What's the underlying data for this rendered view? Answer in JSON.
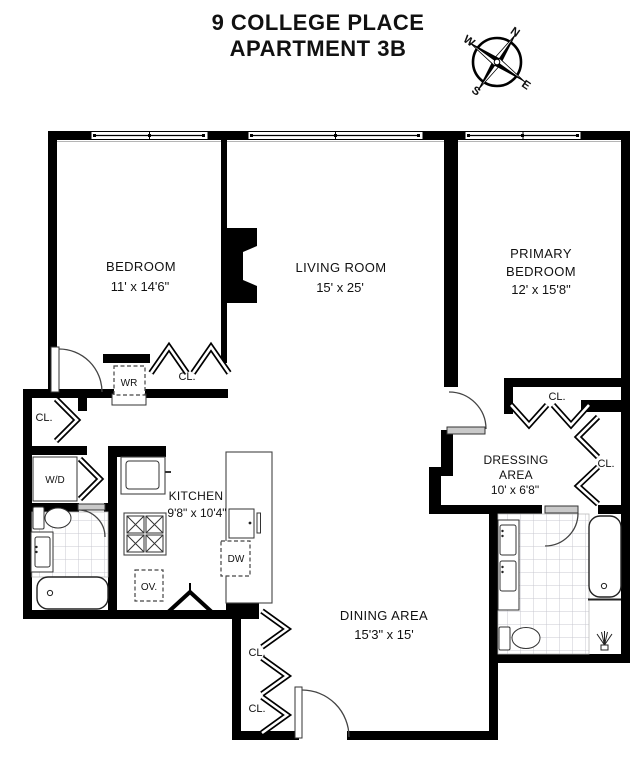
{
  "title": {
    "line1": "9 COLLEGE PLACE",
    "line2": "APARTMENT 3B"
  },
  "compass": {
    "n": "N",
    "e": "E",
    "s": "S",
    "w": "W"
  },
  "rooms": {
    "bedroom": {
      "name": "BEDROOM",
      "dims": "11' x 14'6\""
    },
    "living": {
      "name": "LIVING ROOM",
      "dims": "15' x 25'"
    },
    "primary": {
      "name1": "PRIMARY",
      "name2": "BEDROOM",
      "dims": "12' x 15'8\""
    },
    "dressing": {
      "name1": "DRESSING",
      "name2": "AREA",
      "dims": "10' x 6'8\""
    },
    "kitchen": {
      "name": "KITCHEN",
      "dims": "9'8\" x 10'4\""
    },
    "dining": {
      "name": "DINING AREA",
      "dims": "15'3\" x 15'"
    }
  },
  "labels": {
    "closet": "CL.",
    "wr": "WR",
    "wd": "W/D",
    "oven": "OV.",
    "dw": "DW"
  },
  "colors": {
    "wall": "#000000",
    "text": "#111111",
    "tile_line": "#c9c9d1",
    "door_arc": "#444444"
  }
}
